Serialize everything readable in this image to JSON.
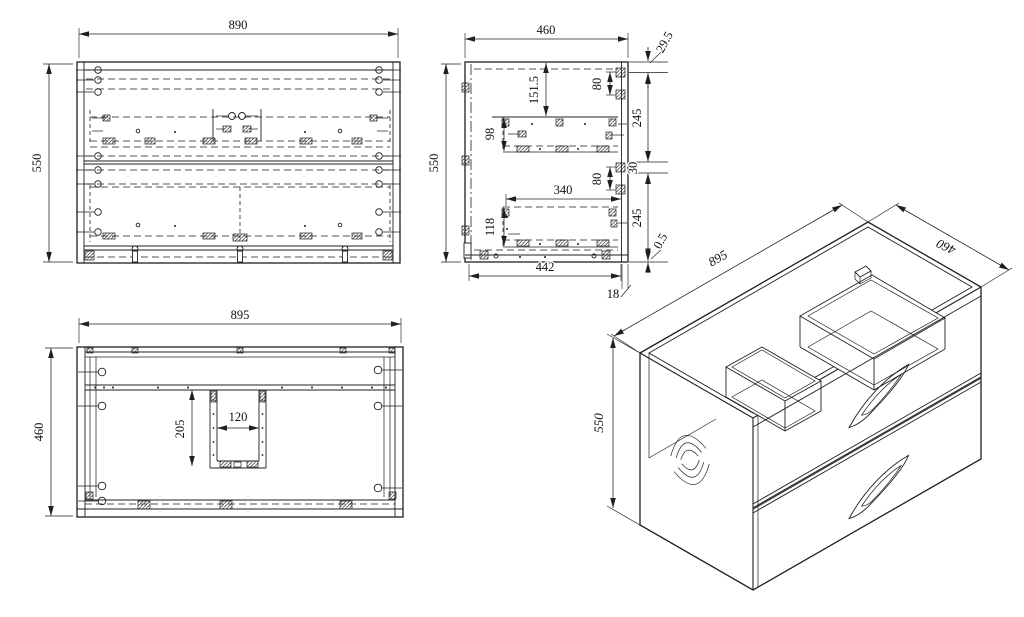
{
  "drawing": {
    "type": "technical-drawing",
    "subject": "two-drawer wall-hung vanity cabinet",
    "background": "#ffffff",
    "line_color": "#1f1f1f",
    "views": {
      "front": {
        "width": "890",
        "height": "550"
      },
      "side": {
        "depth": "460",
        "height": "550",
        "top_reveal": "29.5",
        "hinge_pitch_top": "80",
        "runner_setdown": "151.5",
        "upper_box_height": "98",
        "upper_drawer_front": "245",
        "drawer_gap": "30",
        "hinge_pitch_bottom": "80",
        "lower_box_depth": "340",
        "lower_box_height": "118",
        "lower_drawer_front": "245",
        "bottom_reveal": "0.5",
        "inner_depth": "442",
        "back_panel_thickness": "18"
      },
      "top": {
        "width": "895",
        "depth": "460",
        "cutout_depth": "205",
        "cutout_width": "120"
      },
      "isometric": {
        "width": "895",
        "depth": "460",
        "height": "550"
      }
    }
  }
}
